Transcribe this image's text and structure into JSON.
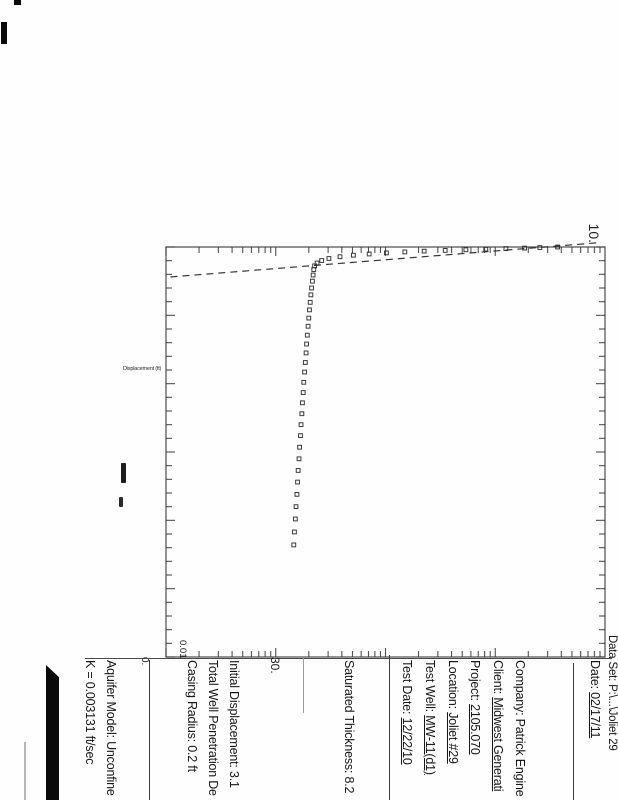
{
  "document": {
    "kind": "scanned slug test analysis chart page",
    "orientation_note": "landscape page rotated 90deg clockwise in scan"
  },
  "panel": {
    "data_set_line": {
      "label": "Data Set:",
      "value": "P:\\...\\Joliet 29"
    },
    "date_line": {
      "label": "Date:",
      "value": "02/17/11"
    },
    "project_info": [
      {
        "label": "Company:",
        "value": "Patrick Engine"
      },
      {
        "label": "Client:",
        "value": "Midwest Generati"
      },
      {
        "label": "Project:",
        "value": "2105.070"
      },
      {
        "label": "Location:",
        "value": "Joliet #29"
      },
      {
        "label": "Test Well:",
        "value": "MW-11(d1)"
      },
      {
        "label": "Test Date:",
        "value": "12/22/10"
      }
    ],
    "aquifer_data": [
      {
        "label": "Saturated Thickness:",
        "value": "8.2"
      }
    ],
    "well_data": [
      {
        "label": "Initial Displacement:",
        "value": "3.1"
      },
      {
        "label": "Total Well Penetration De",
        "value": ""
      },
      {
        "label": "Casing Radius:",
        "value": "0.2 ft"
      }
    ],
    "solution": [
      {
        "label": "Aquifer Model:",
        "value": "Unconfine"
      },
      {
        "label": "K  =",
        "value": "0.003131 ft/sec"
      }
    ],
    "fragments": {
      "frag_30": "30.",
      "frag_0": "0.",
      "frag_001": "0.01"
    }
  },
  "chart_data": {
    "type": "scatter",
    "title": "",
    "xlabel": "",
    "ylabel": "Displacement (ft)",
    "x_axis": {
      "scale": "linear",
      "min": 0,
      "max": 30,
      "minor_step": 1,
      "major_step": 5
    },
    "y_axis": {
      "scale": "log",
      "min": 0.001,
      "max": 10,
      "top_label": "10."
    },
    "legend_position": "none",
    "grid": false,
    "marker": "open-square",
    "frame": {
      "x": 247,
      "y": 13,
      "w": 410,
      "h": 439
    },
    "series": [
      {
        "name": "displacement",
        "points": [
          [
            0.0,
            3.7
          ],
          [
            0.04,
            2.55
          ],
          [
            0.08,
            1.85
          ],
          [
            0.12,
            1.25
          ],
          [
            0.16,
            0.82
          ],
          [
            0.2,
            0.54
          ],
          [
            0.25,
            0.35
          ],
          [
            0.3,
            0.225
          ],
          [
            0.36,
            0.15
          ],
          [
            0.43,
            0.102
          ],
          [
            0.51,
            0.071
          ],
          [
            0.6,
            0.051
          ],
          [
            0.71,
            0.0385
          ],
          [
            0.84,
            0.0305
          ],
          [
            0.99,
            0.0262
          ],
          [
            1.17,
            0.0238
          ],
          [
            1.38,
            0.0226
          ],
          [
            1.65,
            0.0222
          ],
          [
            2.05,
            0.0219
          ],
          [
            2.5,
            0.0216
          ],
          [
            3.0,
            0.0212
          ],
          [
            3.5,
            0.0209
          ],
          [
            4.05,
            0.0206
          ],
          [
            4.6,
            0.0203
          ],
          [
            5.2,
            0.02
          ],
          [
            5.8,
            0.0197
          ],
          [
            6.45,
            0.0194
          ],
          [
            7.1,
            0.0191
          ],
          [
            7.75,
            0.0189
          ],
          [
            8.45,
            0.0186
          ],
          [
            9.15,
            0.0183
          ],
          [
            9.9,
            0.018
          ],
          [
            10.65,
            0.0178
          ],
          [
            11.4,
            0.0175
          ],
          [
            12.2,
            0.0173
          ],
          [
            13.0,
            0.017
          ],
          [
            13.8,
            0.0168
          ],
          [
            14.65,
            0.0165
          ],
          [
            15.5,
            0.0163
          ],
          [
            16.35,
            0.016
          ],
          [
            17.2,
            0.0158
          ],
          [
            18.1,
            0.0156
          ],
          [
            19.0,
            0.0153
          ],
          [
            19.9,
            0.0151
          ],
          [
            20.85,
            0.0148
          ],
          [
            21.8,
            0.0146
          ]
        ]
      }
    ],
    "fit_line": {
      "style": "dashed",
      "points": [
        [
          -0.3,
          8.3
        ],
        [
          2.2,
          0.00107
        ]
      ]
    }
  }
}
